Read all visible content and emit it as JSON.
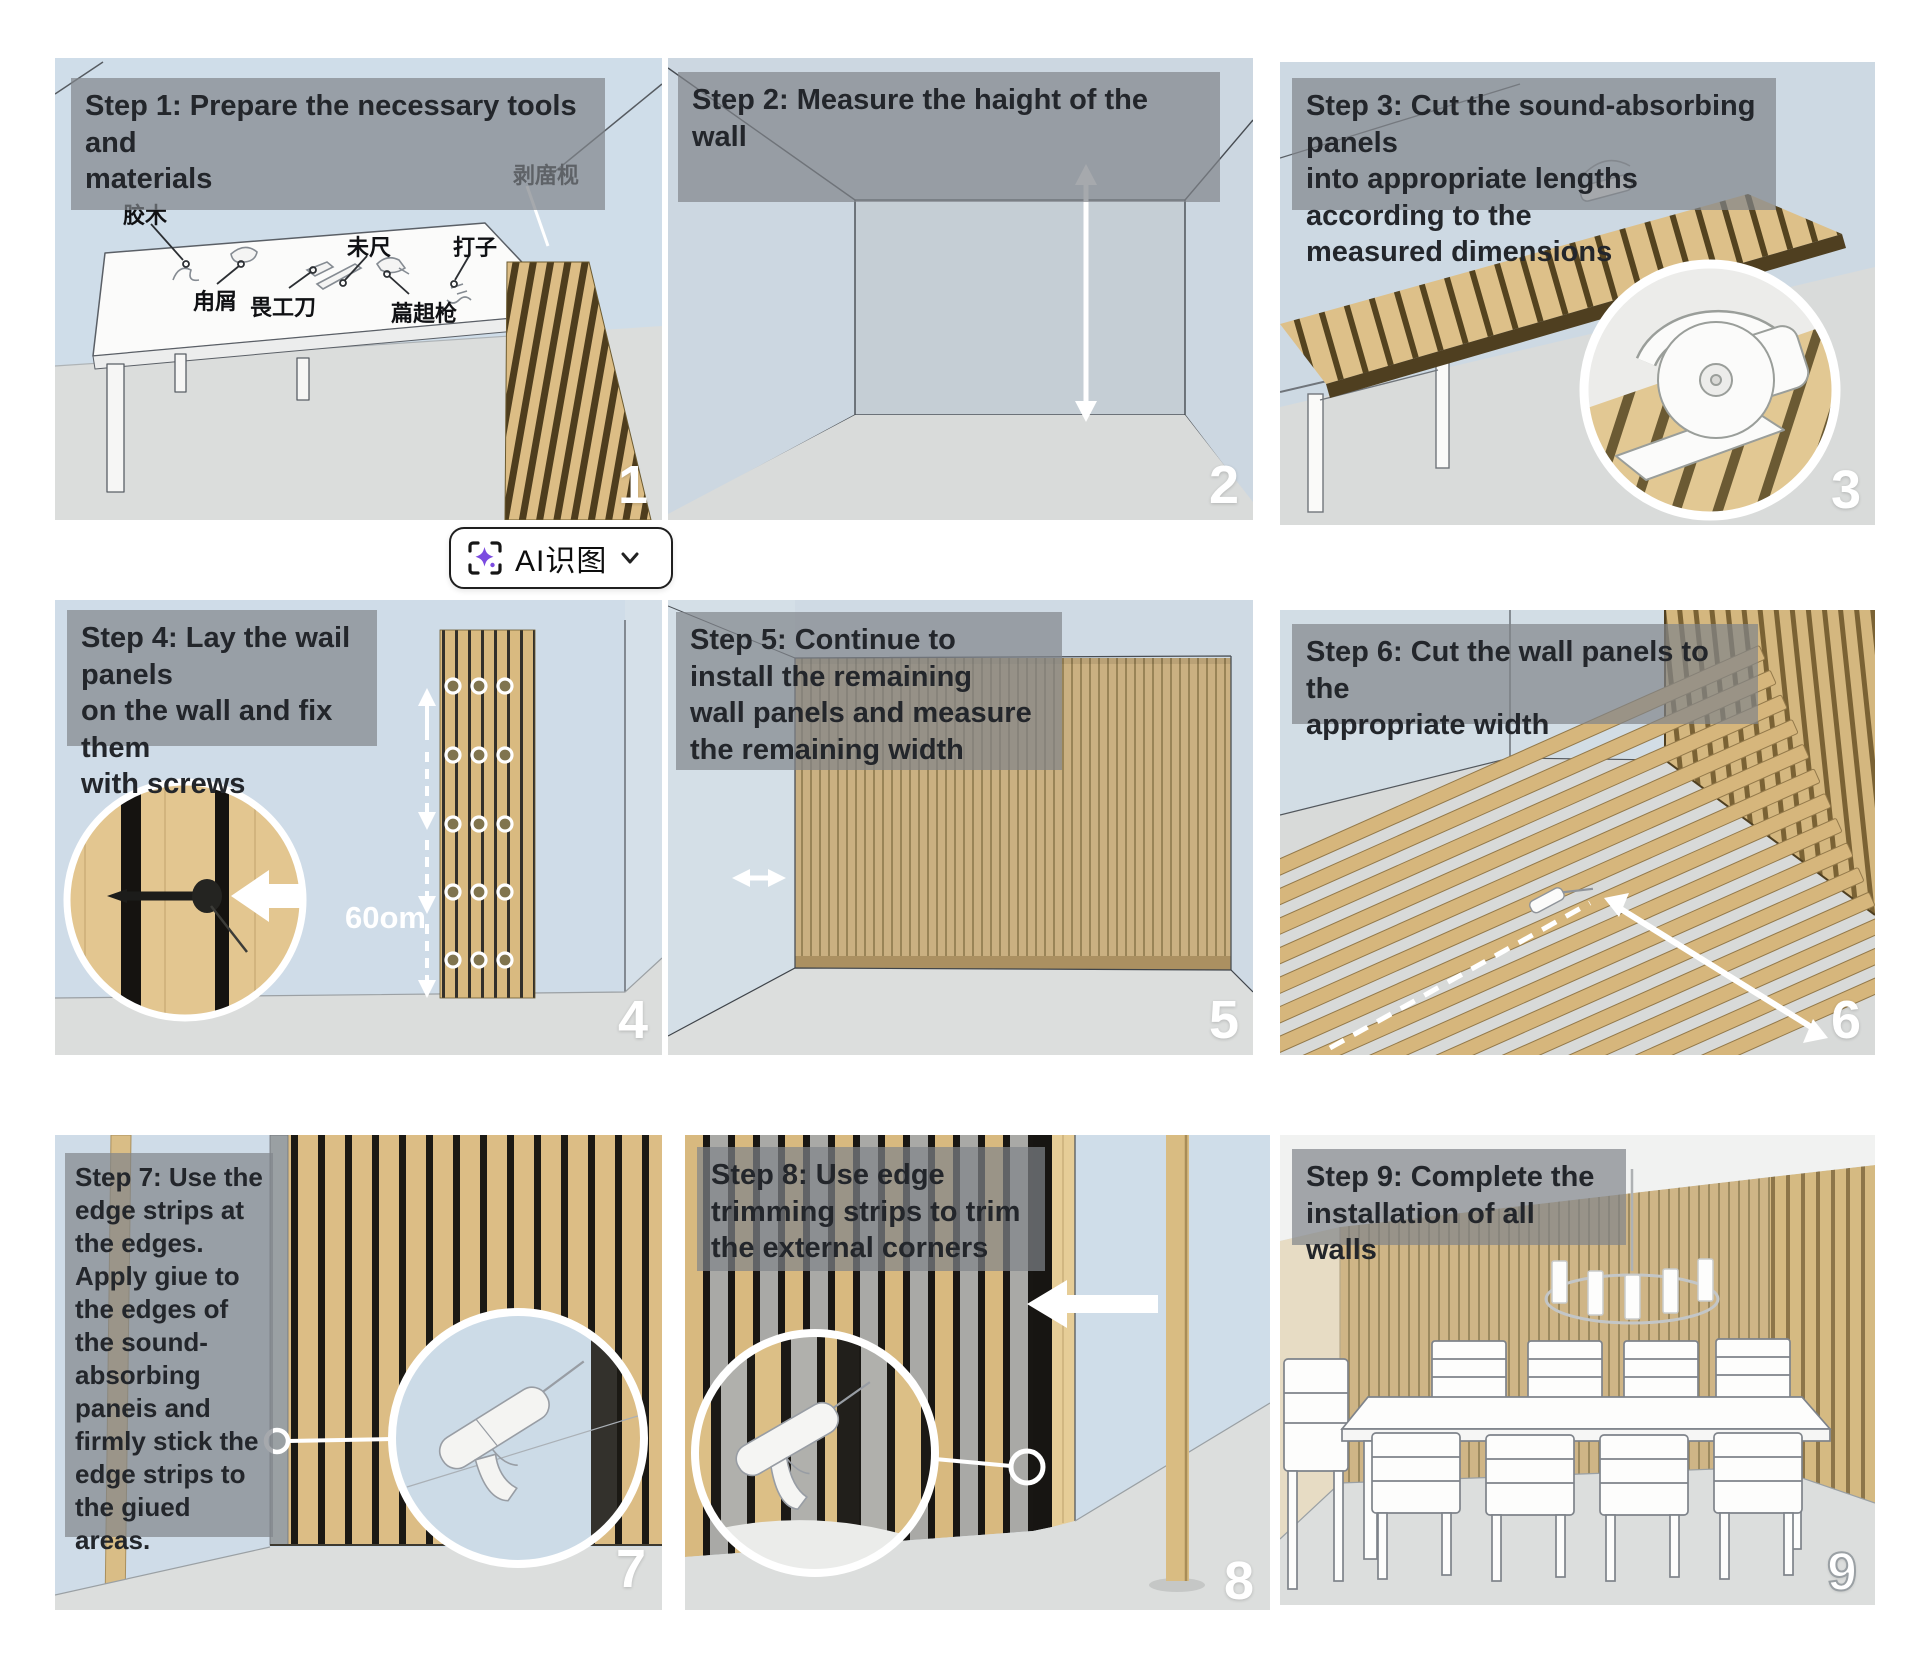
{
  "ai_button": {
    "label": "AI识图"
  },
  "colors": {
    "wood": "#d9bc85",
    "groove": "#1b1914",
    "wall_blue": "#cfdce7",
    "floor_gray": "#dcdedd",
    "caption_overlay": "#82868a",
    "number_color": "#ffffff",
    "accent_purple": "#7b4be0"
  },
  "panels": [
    {
      "number": "1",
      "caption": "Step 1: Prepare the necessary tools and\nmaterials",
      "labels": [
        "胶木",
        "甪屑",
        "未尺",
        "畏工刀",
        "打子",
        "萹趄枪",
        "剥庿枧"
      ]
    },
    {
      "number": "2",
      "caption": "Step 2: Measure the haight of the wall"
    },
    {
      "number": "3",
      "caption": "Step 3: Cut the sound-absorbing panels\ninto appropriate lengths according to the\nmeasured dimensions"
    },
    {
      "number": "4",
      "caption": "Step 4: Lay the wail panels\non the wall and fix them\nwith screws",
      "measurement": "60om"
    },
    {
      "number": "5",
      "caption": "Step 5: Continue to\ninstall the remaining\nwall panels and measure\nthe remaining width"
    },
    {
      "number": "6",
      "caption": "Step 6: Cut the wall panels to the\nappropriate width"
    },
    {
      "number": "7",
      "caption": "Step 7: Use the\nedge strips at\nthe edges.\nApply giue to\nthe edges of\nthe sound-\nabsorbing\npaneis and\nfirmly stick the\nedge strips to\nthe giued areas."
    },
    {
      "number": "8",
      "caption": "Step 8: Use edge\ntrimming strips to trim\nthe external corners"
    },
    {
      "number": "9",
      "caption": "Step 9: Complete the\ninstallation of all walls"
    }
  ]
}
